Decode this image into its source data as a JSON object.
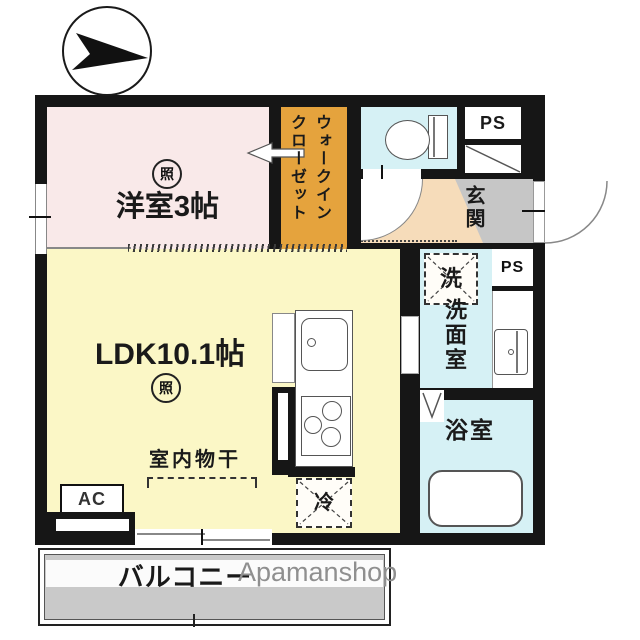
{
  "watermark": "Apamanshop",
  "rooms": {
    "western_room": {
      "label": "洋室3帖",
      "light_badge": "照",
      "color": "#f9e9e9"
    },
    "walk_in_closet": {
      "line1": "ウォークイン",
      "line2": "クローゼット",
      "color": "#e5a33d"
    },
    "toilet": {
      "color": "#d6f1f5"
    },
    "hallway": {
      "color": "#f6dcba"
    },
    "entrance": {
      "label": "玄関",
      "color": "#c6c6c6"
    },
    "ldk": {
      "label": "LDK10.1帖",
      "light_badge": "照",
      "color": "#fbf7c6"
    },
    "washroom": {
      "label": "洗面室",
      "color": "#d6f1f5"
    },
    "bathroom": {
      "label": "浴室",
      "color": "#d6f1f5"
    },
    "balcony": {
      "label": "バルコニー",
      "color": "#c9c9c9"
    }
  },
  "fixtures": {
    "ps_upper": "PS",
    "ps_lower": "PS",
    "washer": "洗",
    "fridge": "冷",
    "ac": "AC",
    "indoor_drying": "室内物干"
  },
  "colors": {
    "wall": "#161616",
    "watermark_gray": "#8f8f8f"
  }
}
